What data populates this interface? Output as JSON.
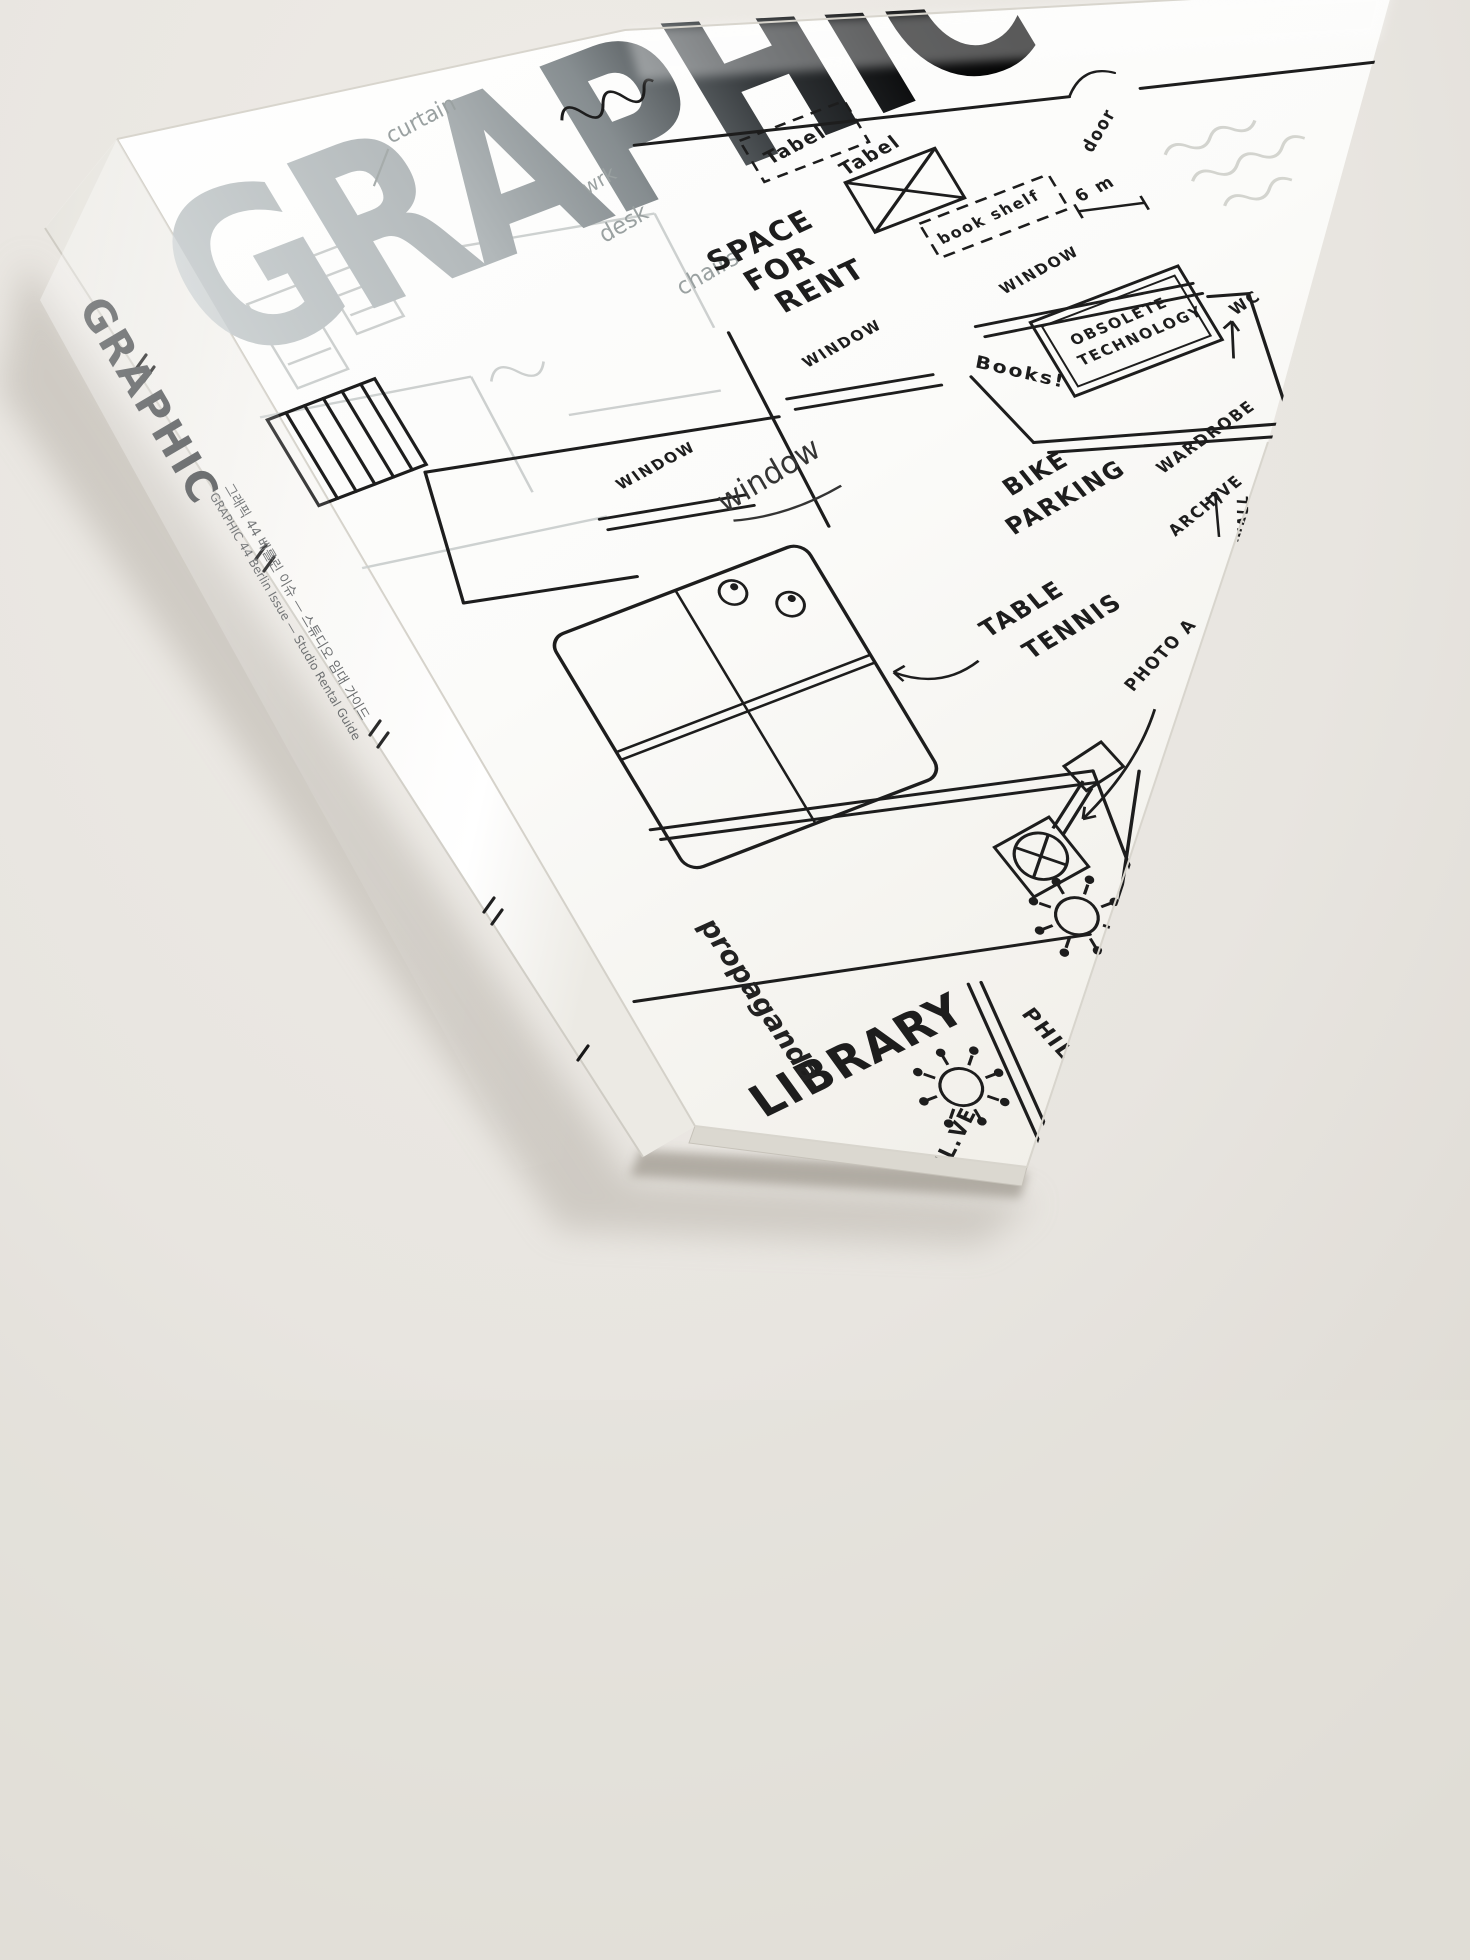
{
  "colors": {
    "table_background": "#e8e5e0",
    "paper_white": "#fcfcfa",
    "plan_ink": "#1d1d1d",
    "masthead_silver": "#b9bec0",
    "masthead_dark": "#141617",
    "pencil_grey": "#9aa1a1",
    "spine_text_grey": "#45484a"
  },
  "spine": {
    "title": "GRAPHIC",
    "subtitle_kr": "그래픽 44 베를린 이슈 — 스튜디오 임대 가이드",
    "subtitle_en": "GRAPHIC 44 Berlin Issue — Studio Rental Guide",
    "publisher": "propaganda"
  },
  "cover": {
    "masthead": "GRAPHIC",
    "masthead_note": "wang",
    "notes": {
      "curtain": "curtain",
      "wrk": "wrk",
      "desk": "desk",
      "chairs": "chairs",
      "window_script": "window"
    },
    "plan": {
      "tabel_1": "Tabel",
      "tabel_2": "Tabel",
      "book_shelf": "book shelf",
      "six_m": "6 m",
      "door": "door",
      "window_1": "WINDOW",
      "window_2": "WINDOW",
      "window_3": "WINDOW",
      "space_for_rent": [
        "SPACE",
        "FOR",
        "RENT"
      ],
      "obsolete_technology": [
        "OBSOLETE",
        "TECHNOLOGY"
      ],
      "books": "Books!",
      "bike_parking": [
        "BIKE",
        "PARKING"
      ],
      "wardrobe": "WARDROBE",
      "archive": "ARCHIVE",
      "wc": "WC",
      "paper_wall": "PAPER WALL",
      "photo_a": "PHOTO A",
      "table_tennis": [
        "TABLE",
        "TENNIS"
      ],
      "library": "LIBRARY",
      "philipp": "PHILIPP",
      "partial_bottom": "IL.VE"
    }
  }
}
